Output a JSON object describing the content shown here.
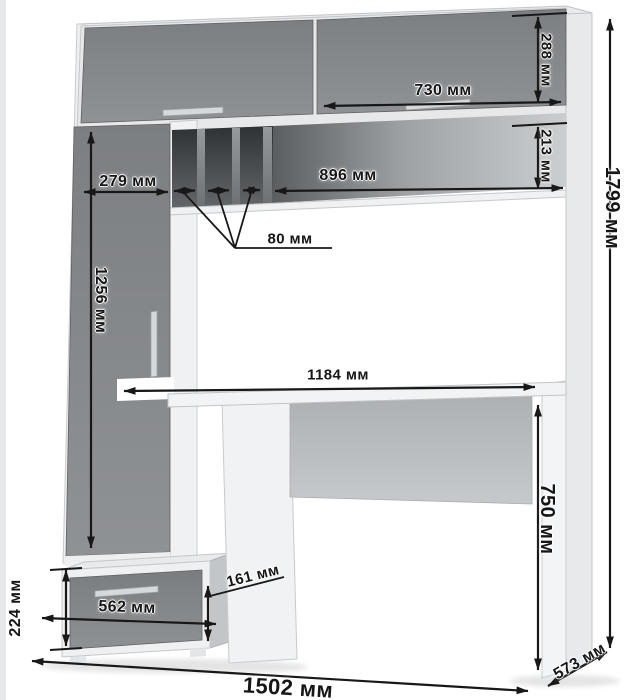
{
  "diagram": {
    "type": "furniture-dimension-drawing",
    "subject": "computer-desk-with-hutch",
    "units": "мм",
    "labels": {
      "hutch_door_height": "288 мм",
      "hutch_right_door_width": "730 мм",
      "niche_height": "213 мм",
      "niche_width": "896 мм",
      "left_section_width": "279 мм",
      "slot_width": "80 мм",
      "tall_door_height": "1256 мм",
      "desktop_width": "1184 мм",
      "desktop_height": "750 мм",
      "total_height": "1799 мм",
      "pedestal_height": "224 мм",
      "drawer_width": "562 мм",
      "drawer_front_height": "161 мм",
      "total_width": "1502 мм",
      "depth": "573 мм"
    },
    "colors": {
      "front_gray": "#85888b",
      "carcass_white": "#f0f2f3",
      "niche_dark": "#3a3d40",
      "dimension_ink": "#181818",
      "background": "#ffffff"
    }
  }
}
